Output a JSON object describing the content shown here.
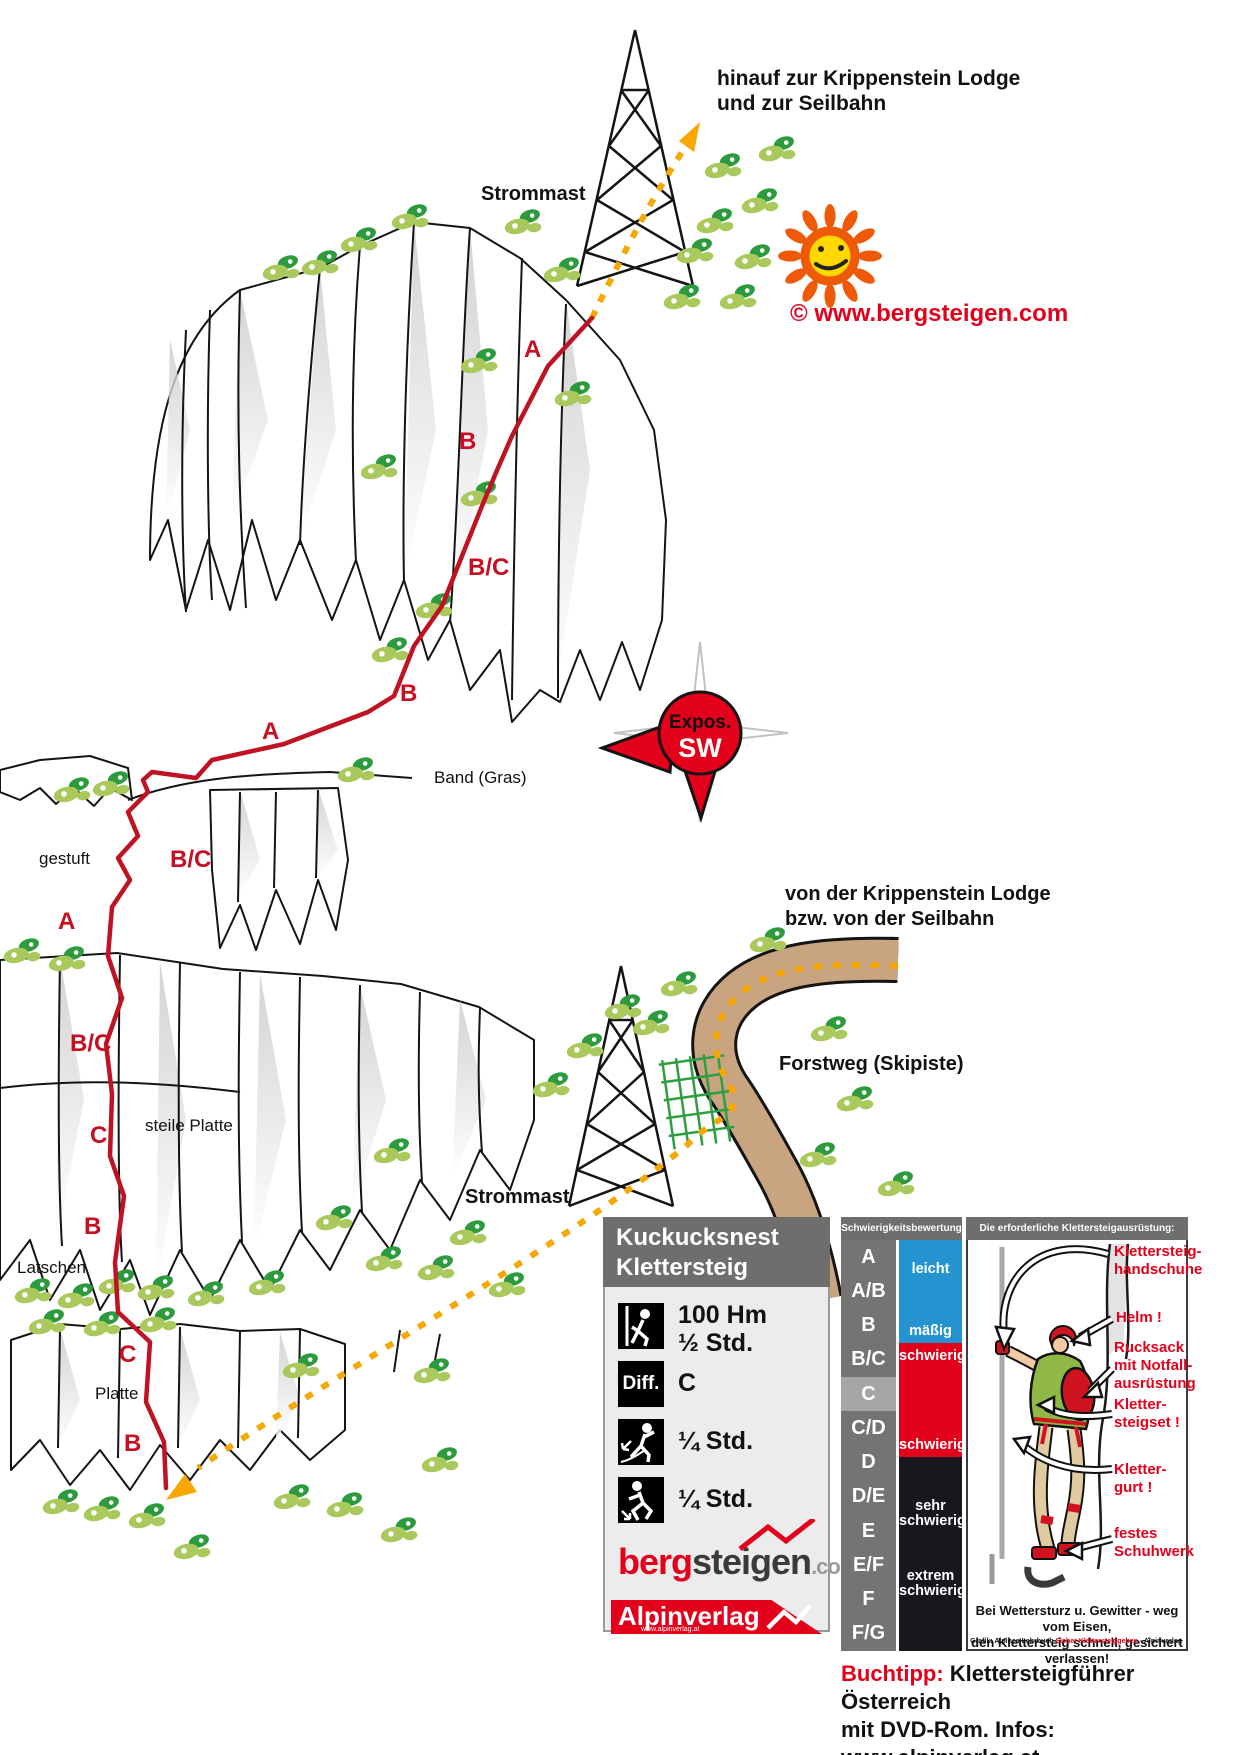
{
  "map": {
    "copyright": "© www.bergsteigen.com",
    "direction_top": [
      "hinauf zur Krippenstein Lodge",
      "und zur Seilbahn"
    ],
    "direction_mid": [
      "von der Krippenstein Lodge",
      "bzw.  von der Seilbahn"
    ],
    "labels": {
      "strommast_top": "Strommast",
      "strommast_bottom": "Strommast",
      "band_gras": "Band (Gras)",
      "gestuft": "gestuft",
      "steile_platte": "steile Platte",
      "latschen": "Latschen",
      "platte": "Platte",
      "forstweg": "Forstweg (Skipiste)"
    },
    "compass": {
      "line1": "Expos.",
      "line2": "SW"
    },
    "grade_labels": [
      {
        "text": "A",
        "x": 524,
        "y": 336
      },
      {
        "text": "B",
        "x": 459,
        "y": 428
      },
      {
        "text": "B/C",
        "x": 468,
        "y": 554
      },
      {
        "text": "B",
        "x": 400,
        "y": 680
      },
      {
        "text": "A",
        "x": 262,
        "y": 718
      },
      {
        "text": "B/C",
        "x": 170,
        "y": 846
      },
      {
        "text": "A",
        "x": 58,
        "y": 908
      },
      {
        "text": "B/C",
        "x": 70,
        "y": 1030
      },
      {
        "text": "C",
        "x": 90,
        "y": 1122
      },
      {
        "text": "B",
        "x": 84,
        "y": 1213
      },
      {
        "text": "C",
        "x": 119,
        "y": 1341
      },
      {
        "text": "B",
        "x": 124,
        "y": 1430
      }
    ]
  },
  "infobox": {
    "title": [
      "Kuckucksnest",
      "Klettersteig"
    ],
    "stats": [
      {
        "icon": "climb-stats-icon",
        "lines": [
          "100 Hm",
          "½ Std."
        ]
      },
      {
        "icon": "difficulty-icon",
        "icon_text": "Diff.",
        "lines": [
          "C"
        ]
      },
      {
        "icon": "approach-walk-icon",
        "lines": [
          "¼ Std."
        ]
      },
      {
        "icon": "descent-walk-icon",
        "lines": [
          "¼ Std."
        ]
      }
    ],
    "logo_bergsteigen": {
      "part1": "berg",
      "part2": "steigen",
      "part3": ".com"
    },
    "logo_alpinverlag": {
      "name": "Alpinverlag",
      "url": "www.alpinverlag.at"
    }
  },
  "legend": {
    "scale": {
      "header": "Schwierigkeitsbewertung",
      "grades": [
        "A",
        "A/B",
        "B",
        "B/C",
        "C",
        "C/D",
        "D",
        "D/E",
        "E",
        "E/F",
        "F",
        "F/G"
      ],
      "highlighted": "C",
      "bands": [
        {
          "label_top": "leicht",
          "label_bottom": "mäßig",
          "color": "#2693d1"
        },
        {
          "label_top": "schwierig",
          "label_bottom": "schwierig",
          "color": "#e2001a"
        },
        {
          "label_top": "sehr schwierig",
          "label_bottom": "extrem schwierig",
          "color": "#17171d"
        }
      ]
    },
    "equipment": {
      "header": "Die erforderliche Klettersteigausrüstung:",
      "callouts": [
        {
          "lines": [
            "Klettersteig-",
            "handschuhe"
          ],
          "x": 146,
          "y": 24
        },
        {
          "lines": [
            "Helm !"
          ],
          "x": 148,
          "y": 90
        },
        {
          "lines": [
            "Rucksack",
            "mit Notfall-",
            "ausrüstung"
          ],
          "x": 146,
          "y": 120
        },
        {
          "lines": [
            "Kletter-",
            "steigset !"
          ],
          "x": 146,
          "y": 177
        },
        {
          "lines": [
            "Kletter-",
            "gurt !"
          ],
          "x": 146,
          "y": 242
        },
        {
          "lines": [
            "festes",
            "Schuhwerk"
          ],
          "x": 146,
          "y": 306
        }
      ],
      "warning": [
        "Bei Wettersturz u. Gewitter - weg vom Eisen,",
        "den Klettersteig schnell, gesichert verlassen!"
      ],
      "credit_parts": [
        "Grafik: Alpines Lehrbuch ",
        "Sicher Klettersteiggehen",
        " - Alpinverlag"
      ]
    }
  },
  "footer": {
    "tip_label": "Buchtipp:",
    "tip_rest": " Klettersteigführer Österreich",
    "line2": "mit DVD-Rom. Infos: www.alpinverlag.at"
  },
  "colors": {
    "route_red": "#bf1222",
    "accent_red": "#e2001a",
    "trail_orange": "#f6a800",
    "road_brown": "#c9a480",
    "tree_light": "#a9c95d",
    "tree_dark": "#2c9a3d",
    "header_gray": "#6e6e6d",
    "scale_blue": "#2693d1",
    "scale_dark": "#17171d"
  }
}
